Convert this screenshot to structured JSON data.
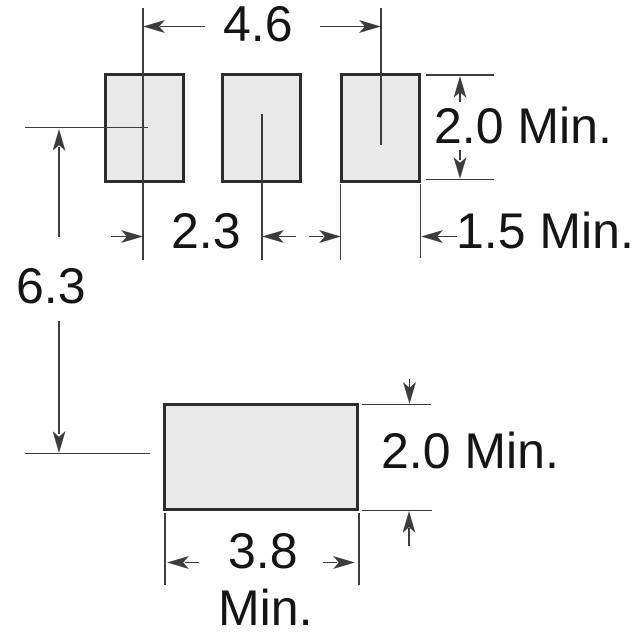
{
  "diagram": {
    "kind": "land-pattern-dimension-drawing",
    "upper_pad_count": 3,
    "lower_pad_count": 1
  },
  "labels": {
    "upper_outer_pitch": "4.6",
    "upper_pad_height": "2.0 Min.",
    "upper_pad_pitch": "2.3",
    "upper_pad_width": "1.5 Min.",
    "row_spacing": "6.3",
    "lower_pad_height": "2.0 Min.",
    "lower_pad_width_value": "3.8",
    "lower_pad_width_suffix": "Min."
  },
  "colors": {
    "pad_fill": "#e9e9e9",
    "pad_border": "#2c2c2c",
    "line": "#3c3c3c",
    "text": "#151515",
    "bg": "#ffffff"
  }
}
